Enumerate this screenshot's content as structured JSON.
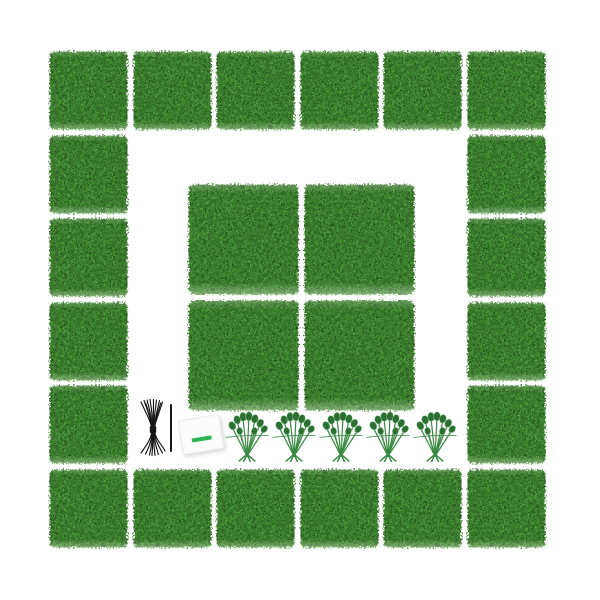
{
  "scene": {
    "description": "Product photo: artificial boxwood hedge grass wall panel kit on white background",
    "background_color": "#ffffff",
    "ring": {
      "label": "border of small hedge panels",
      "rows": 6,
      "cols": 6,
      "origin_x": 48,
      "origin_y": 50,
      "pitch": 83.5,
      "panel_size": 81,
      "panel_count": 20
    },
    "center_grid": {
      "label": "center grid of large hedge panels",
      "rows": 2,
      "cols": 2,
      "origin_x": 187,
      "origin_y": 183,
      "pitch": 115.5,
      "panel_size": 113,
      "panel_count": 4
    },
    "accessories": {
      "zip_tie_bundle": {
        "label": "bundle of black cable ties",
        "x": 138,
        "y": 399,
        "width": 30,
        "height": 58
      },
      "single_tie": {
        "label": "single black cable tie",
        "x": 170,
        "y": 404,
        "width": 1.6,
        "height": 48
      },
      "manual_card": {
        "label": "white instruction card with green stripe",
        "x": 180,
        "y": 417,
        "width": 40,
        "height": 33,
        "rotation_deg": -9
      },
      "greenery_clusters": {
        "label": "green connector sprigs",
        "count": 5,
        "centers_x": [
          247,
          294,
          341,
          388,
          435
        ],
        "top_y": 411,
        "width": 44,
        "height": 51
      }
    }
  },
  "colors": {
    "grass_mid": "#3b7a2e",
    "grass_dark": "#1d421f",
    "grass_light": "#8ed272",
    "tie_black": "#151515",
    "card_white": "#fcfcfc",
    "stripe_green": "#2fb457",
    "stem_green": "#3a8a44",
    "leaf_green": "#2d6e35",
    "leaf_highlight": "#8cc98f"
  }
}
